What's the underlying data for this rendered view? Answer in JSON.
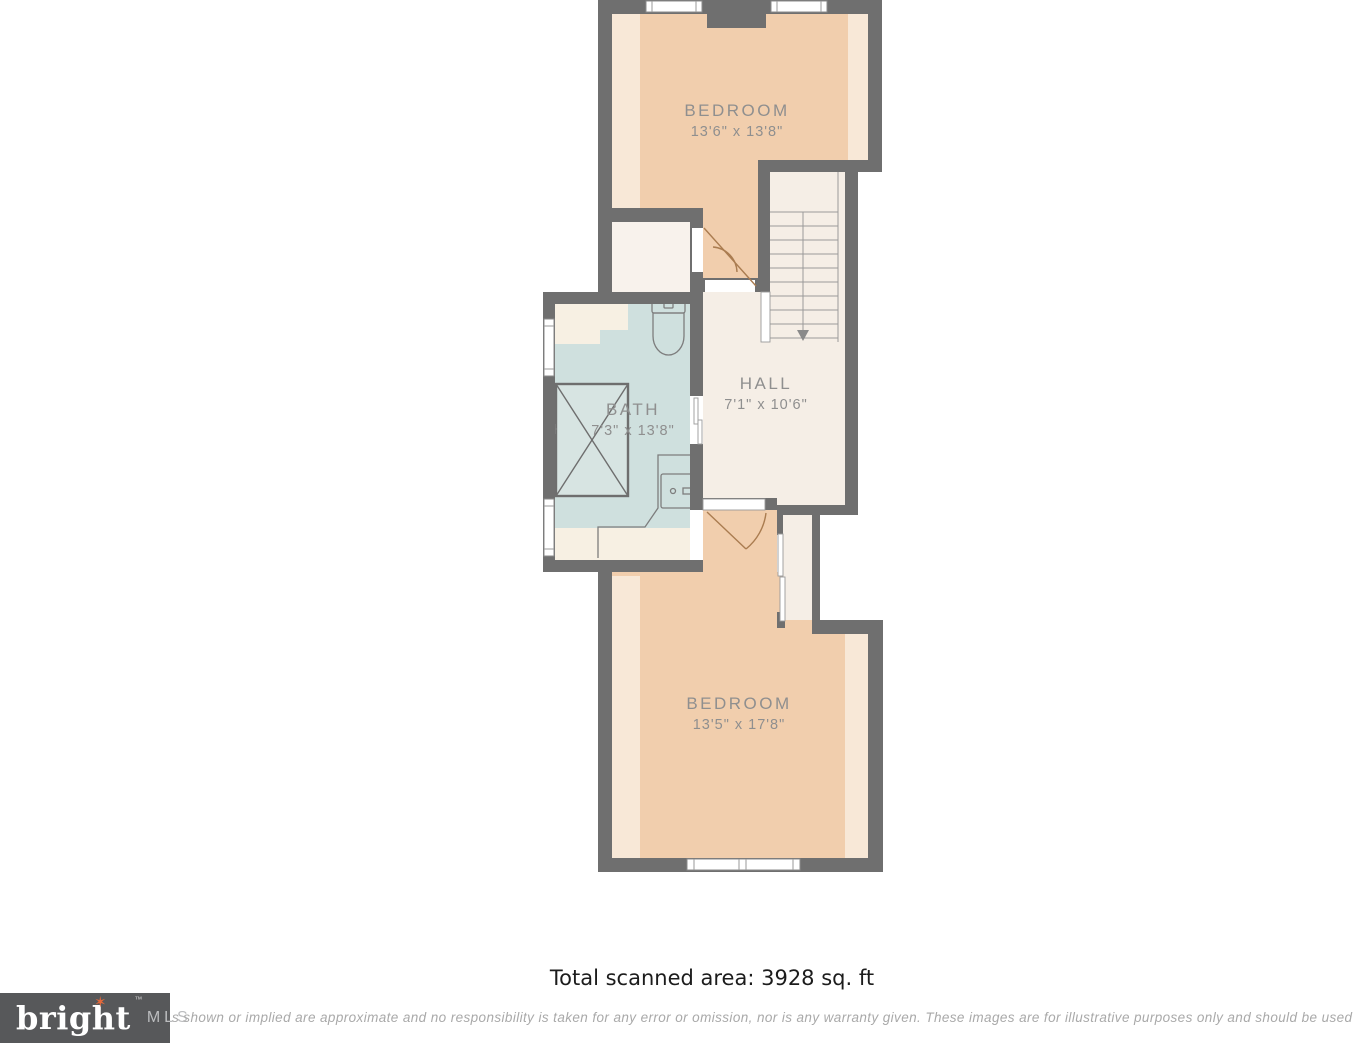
{
  "plan": {
    "rooms": {
      "bedroom_top": {
        "label": "BEDROOM",
        "dimensions": "13'6\" x 13'8\""
      },
      "bath": {
        "label": "BATH",
        "dimensions": "7'3\" x 13'8\""
      },
      "hall": {
        "label": "HALL",
        "dimensions": "7'1\" x 10'6\""
      },
      "bedroom_bottom": {
        "label": "BEDROOM",
        "dimensions": "13'5\" x 17'8\""
      }
    }
  },
  "footer": {
    "total_area": "Total scanned area: 3928 sq. ft",
    "disclaimer": "s shown or implied are approximate and no responsibility is taken for any error or omission, nor is any warranty given.  These images are for illustrative purposes only and should be used as such",
    "logo": {
      "brand": "bright",
      "suffix": "MLS",
      "trademark": "™"
    }
  },
  "colors": {
    "wall": "#6f6f6f",
    "bedroom_fill": "#f1cead",
    "bedroom_fill_light": "#f8e8d7",
    "bath_fill": "#cfe0de",
    "hall_fill": "#f5eee6",
    "label_text": "#8f8f8f",
    "logo_background": "#57585a",
    "logo_accent": "#e2683b",
    "disclaimer_text": "#a9a9a9"
  }
}
